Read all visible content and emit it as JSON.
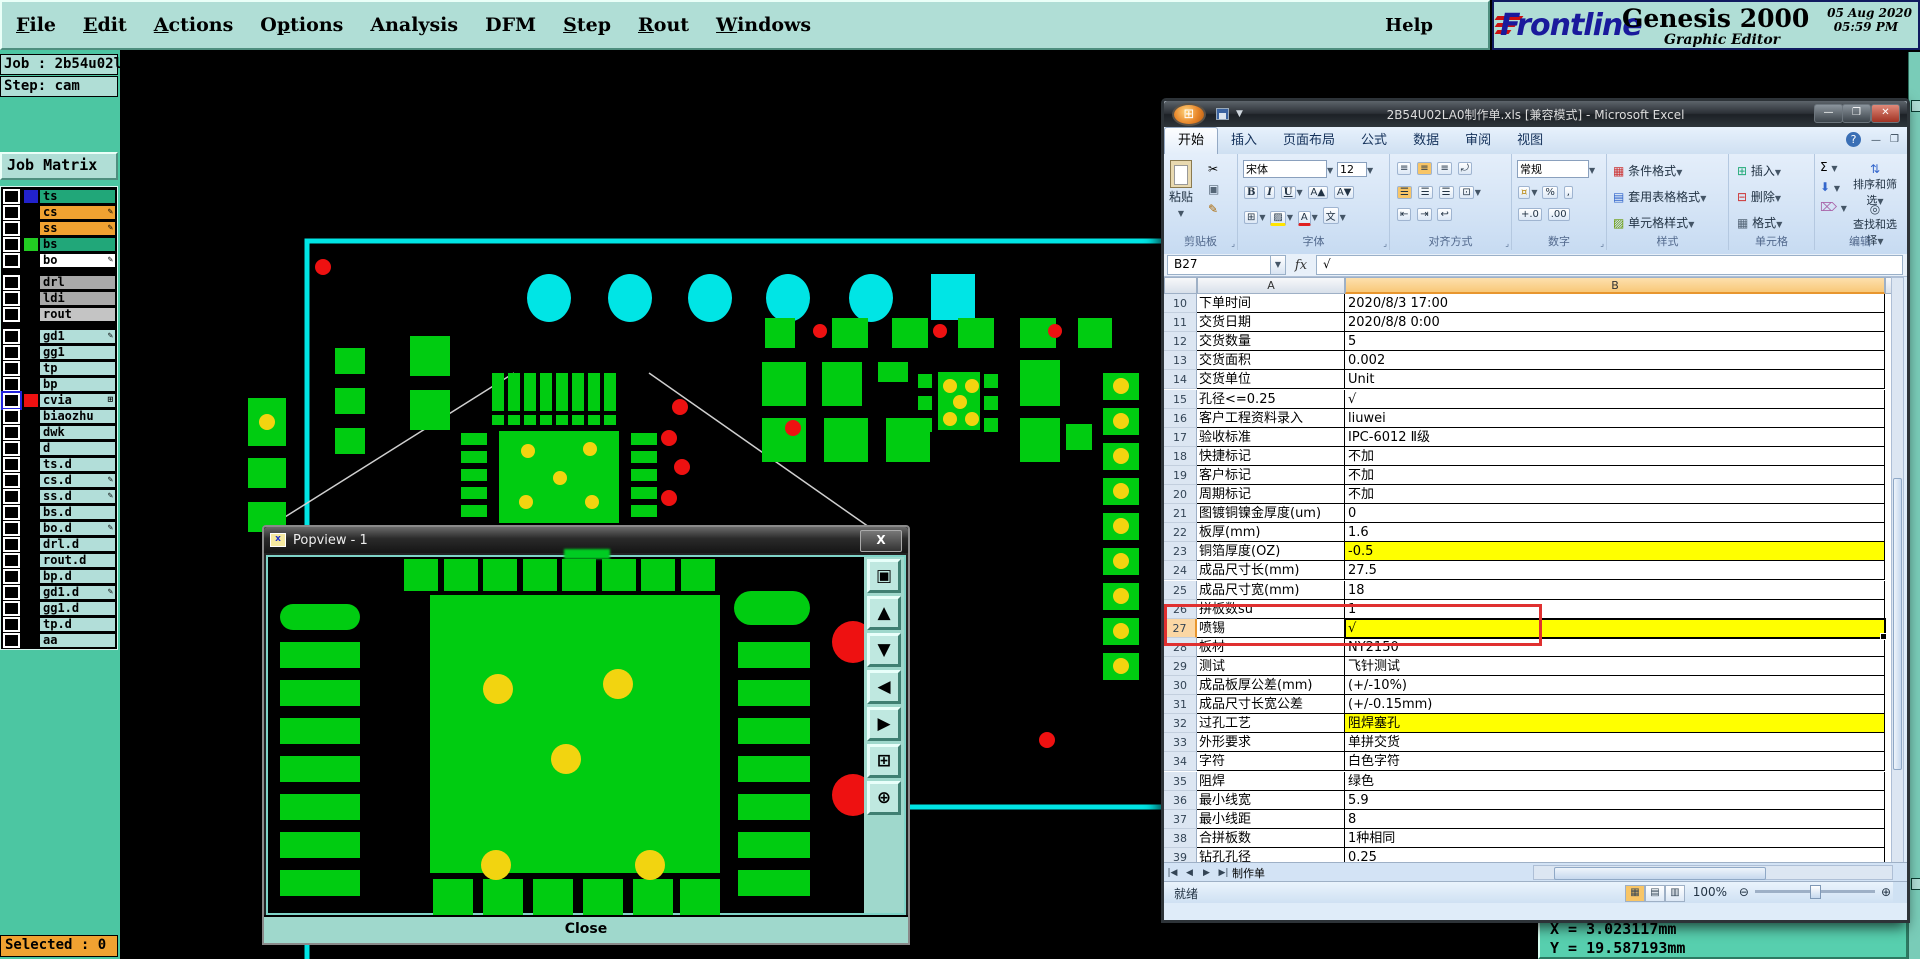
{
  "genesis": {
    "menus": [
      {
        "label": "File",
        "u": 0
      },
      {
        "label": "Edit",
        "u": 0
      },
      {
        "label": "Actions",
        "u": 0
      },
      {
        "label": "Options",
        "u": 1
      },
      {
        "label": "Analysis",
        "u": -1
      },
      {
        "label": "DFM",
        "u": -1
      },
      {
        "label": "Step",
        "u": 0
      },
      {
        "label": "Rout",
        "u": 0
      },
      {
        "label": "Windows",
        "u": 0
      }
    ],
    "help_menu": "Help",
    "logo": {
      "brand": "Frontline",
      "product": "Genesis 2000",
      "subtitle": "Graphic Editor",
      "date": "05 Aug 2020",
      "time": "05:59 PM"
    },
    "job_label": "Job : 2b54u02la0",
    "step_label": "Step: cam",
    "job_matrix_label": "Job Matrix ...",
    "selected_status": "Selected : 0",
    "coord_x": "X  =  3.023117mm",
    "coord_y": "Y  =  19.587193mm",
    "top_buttons": [
      {
        "name": "snapshot-button",
        "glyph": "▣"
      },
      {
        "name": "monitor-button",
        "glyph": "◫"
      },
      {
        "name": "home-button",
        "glyph": "⌂"
      },
      {
        "name": "layers-button",
        "glyph": "▦"
      }
    ],
    "layers": [
      {
        "name": "ts",
        "bar": "#21a779",
        "swatch": "#2222cc",
        "icon": ""
      },
      {
        "name": "cs",
        "bar": "#f0a231",
        "swatch": "#000000",
        "icon": "pencil"
      },
      {
        "name": "ss",
        "bar": "#f0a231",
        "swatch": "#000000",
        "icon": "pencil"
      },
      {
        "name": "bs",
        "bar": "#21a779",
        "swatch": "#22cc22",
        "icon": ""
      },
      {
        "name": "bo",
        "bar": "#ffffff",
        "swatch": "#000000",
        "icon": "pencil"
      },
      {
        "name": "drl",
        "bar": "#a9a9a9",
        "swatch": "",
        "icon": "",
        "gap": true
      },
      {
        "name": "ldi",
        "bar": "#a9a9a9",
        "swatch": "",
        "icon": ""
      },
      {
        "name": "rout",
        "bar": "#c4c4c4",
        "swatch": "",
        "icon": ""
      },
      {
        "name": "gd1",
        "bar": "#b2ded9",
        "swatch": "",
        "icon": "pencil",
        "gap": true
      },
      {
        "name": "gg1",
        "bar": "#b2ded9",
        "swatch": "",
        "icon": ""
      },
      {
        "name": "tp",
        "bar": "#b2ded9",
        "swatch": "",
        "icon": ""
      },
      {
        "name": "bp",
        "bar": "#b2ded9",
        "swatch": "",
        "icon": ""
      },
      {
        "name": "cvia",
        "bar": "#b2ded9",
        "swatch": "#ee1111",
        "icon": "grid",
        "checkbox": "blue"
      },
      {
        "name": "biaozhu",
        "bar": "#b2ded9",
        "swatch": "",
        "icon": ""
      },
      {
        "name": "dwk",
        "bar": "#b2ded9",
        "swatch": "",
        "icon": ""
      },
      {
        "name": "d",
        "bar": "#b2ded9",
        "swatch": "",
        "icon": ""
      },
      {
        "name": "ts.d",
        "bar": "#b2ded9",
        "swatch": "",
        "icon": ""
      },
      {
        "name": "cs.d",
        "bar": "#b2ded9",
        "swatch": "",
        "icon": "pencil"
      },
      {
        "name": "ss.d",
        "bar": "#b2ded9",
        "swatch": "",
        "icon": "pencil"
      },
      {
        "name": "bs.d",
        "bar": "#b2ded9",
        "swatch": "",
        "icon": ""
      },
      {
        "name": "bo.d",
        "bar": "#b2ded9",
        "swatch": "",
        "icon": "pencil"
      },
      {
        "name": "drl.d",
        "bar": "#b2ded9",
        "swatch": "",
        "icon": ""
      },
      {
        "name": "rout.d",
        "bar": "#b2ded9",
        "swatch": "",
        "icon": ""
      },
      {
        "name": "bp.d",
        "bar": "#b2ded9",
        "swatch": "",
        "icon": ""
      },
      {
        "name": "gd1.d",
        "bar": "#b2ded9",
        "swatch": "",
        "icon": "pencil"
      },
      {
        "name": "gg1.d",
        "bar": "#b2ded9",
        "swatch": "",
        "icon": ""
      },
      {
        "name": "tp.d",
        "bar": "#b2ded9",
        "swatch": "",
        "icon": ""
      },
      {
        "name": "aa",
        "bar": "#b2ded9",
        "swatch": "",
        "icon": ""
      }
    ],
    "colors": {
      "panel": "#b0ded6",
      "filler": "#4cc6a2",
      "pad_green": "#00cc11",
      "cyan": "#00e5e5",
      "red": "#ee1111",
      "yellow": "#f2d410"
    }
  },
  "popview": {
    "title": "Popview - 1",
    "close_x": "X",
    "close_label": "Close",
    "tools": [
      {
        "name": "new-window",
        "glyph": "▣"
      },
      {
        "name": "pan-up",
        "glyph": "▲"
      },
      {
        "name": "pan-down",
        "glyph": "▼"
      },
      {
        "name": "pan-left",
        "glyph": "◀"
      },
      {
        "name": "pan-right",
        "glyph": "▶"
      },
      {
        "name": "zoom-fit",
        "glyph": "⊞"
      },
      {
        "name": "zoom-center",
        "glyph": "⊕"
      }
    ]
  },
  "excel": {
    "title": "2B54U02LA0制作单.xls [兼容模式] - Microsoft Excel",
    "window_buttons": {
      "minimize": "—",
      "maximize": "❐",
      "close": "✕"
    },
    "ribbon": {
      "tabs": [
        "开始",
        "插入",
        "页面布局",
        "公式",
        "数据",
        "审阅",
        "视图"
      ],
      "active_tab": "开始",
      "paste_label": "粘贴",
      "font_name": "宋体",
      "font_size": "12",
      "number_format": "常规",
      "style_buttons": [
        "条件格式",
        "套用表格格式",
        "单元格样式"
      ],
      "cell_buttons": [
        "插入",
        "删除",
        "格式"
      ],
      "edit_buttons": [
        "排序和筛选",
        "查找和选择"
      ],
      "group_labels": [
        "剪贴板",
        "字体",
        "对齐方式",
        "数字",
        "样式",
        "单元格",
        "编辑"
      ]
    },
    "name_box": "B27",
    "formula_value": "√",
    "columns": [
      "A",
      "B"
    ],
    "rows": [
      {
        "n": "10",
        "a": "下单时间",
        "b": "2020/8/3 17:00"
      },
      {
        "n": "11",
        "a": "交货日期",
        "b": "2020/8/8 0:00"
      },
      {
        "n": "12",
        "a": "交货数量",
        "b": "5"
      },
      {
        "n": "13",
        "a": "交货面积",
        "b": "0.002"
      },
      {
        "n": "14",
        "a": "交货单位",
        "b": "Unit"
      },
      {
        "n": "15",
        "a": "孔径<=0.25",
        "b": "√"
      },
      {
        "n": "16",
        "a": "客户工程资料录入",
        "b": "liuwei"
      },
      {
        "n": "17",
        "a": "验收标准",
        "b": "IPC-6012 Ⅱ级"
      },
      {
        "n": "18",
        "a": "快捷标记",
        "b": "不加"
      },
      {
        "n": "19",
        "a": "客户标记",
        "b": "不加"
      },
      {
        "n": "20",
        "a": "周期标记",
        "b": "不加"
      },
      {
        "n": "21",
        "a": "图镀铜镍金厚度(um)",
        "b": "0"
      },
      {
        "n": "22",
        "a": "板厚(mm)",
        "b": "1.6"
      },
      {
        "n": "23",
        "a": "铜箔厚度(OZ)",
        "b": "-0.5",
        "hl": true
      },
      {
        "n": "24",
        "a": "成品尺寸长(mm)",
        "b": "27.5"
      },
      {
        "n": "25",
        "a": "成品尺寸宽(mm)",
        "b": "18"
      },
      {
        "n": "26",
        "a": "拼板数su",
        "b": "1"
      },
      {
        "n": "27",
        "a": "喷锡",
        "b": "√",
        "hl": true,
        "sel": true
      },
      {
        "n": "28",
        "a": "板材",
        "b": "NY2150"
      },
      {
        "n": "29",
        "a": "测试",
        "b": "飞针测试"
      },
      {
        "n": "30",
        "a": "成品板厚公差(mm)",
        "b": "(+/-10%)"
      },
      {
        "n": "31",
        "a": "成品尺寸长宽公差",
        "b": "(+/-0.15mm)"
      },
      {
        "n": "32",
        "a": "过孔工艺",
        "b": "阻焊塞孔",
        "hl": true
      },
      {
        "n": "33",
        "a": "外形要求",
        "b": "单拼交货"
      },
      {
        "n": "34",
        "a": "字符",
        "b": "白色字符"
      },
      {
        "n": "35",
        "a": "阻焊",
        "b": "绿色"
      },
      {
        "n": "36",
        "a": "最小线宽",
        "b": "5.9"
      },
      {
        "n": "37",
        "a": "最小线距",
        "b": "8"
      },
      {
        "n": "38",
        "a": "合拼板数",
        "b": "1种相同"
      },
      {
        "n": "39",
        "a": "钻孔孔径",
        "b": "0.25"
      },
      {
        "n": "40",
        "a": "孔到线间距",
        "b": "10"
      }
    ],
    "sheet_nav": [
      "|◀",
      "◀",
      "▶",
      "▶|"
    ],
    "sheet_tab": "制作单",
    "status_ready": "就绪",
    "zoom_level": "100%"
  }
}
